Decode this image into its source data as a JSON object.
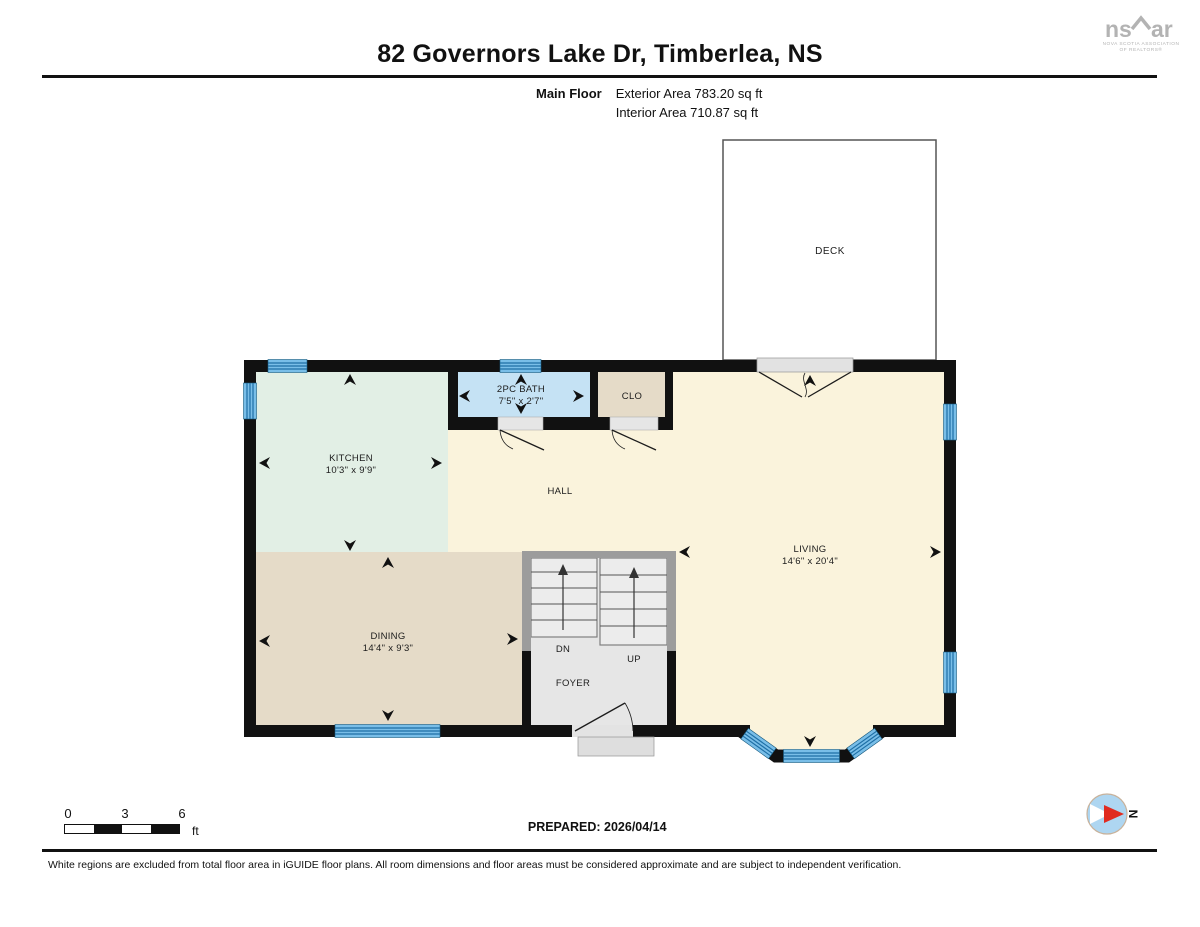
{
  "header": {
    "title": "82 Governors Lake Dr, Timberlea, NS",
    "floor_label": "Main Floor",
    "exterior_area": "Exterior Area 783.20 sq ft",
    "interior_area": "Interior Area 710.87 sq ft"
  },
  "logo": {
    "part1": "ns",
    "part2": "ar",
    "caption_line1": "NOVA SCOTIA ASSOCIATION",
    "caption_line2": "OF REALTORS®"
  },
  "rooms": {
    "deck": {
      "label": "DECK"
    },
    "kitchen": {
      "label": "KITCHEN",
      "dims": "10'3\" x 9'9\""
    },
    "bath": {
      "label": "2PC BATH",
      "dims": "7'5\" x 2'7\""
    },
    "closet": {
      "label": "CLO"
    },
    "hall": {
      "label": "HALL"
    },
    "living": {
      "label": "LIVING",
      "dims": "14'6\" x 20'4\""
    },
    "dining": {
      "label": "DINING",
      "dims": "14'4\" x 9'3\""
    },
    "foyer": {
      "label": "FOYER"
    },
    "stairs": {
      "down": "DN",
      "up": "UP"
    }
  },
  "footer": {
    "scale": {
      "tick0": "0",
      "tick3": "3",
      "tick6": "6",
      "unit": "ft"
    },
    "prepared": "PREPARED: 2026/04/14",
    "compass_north": "N",
    "disclaimer": "White regions are excluded from total floor area in iGUIDE floor plans. All room dimensions and floor areas must be considered approximate and are subject to independent verification."
  },
  "colors": {
    "wall": "#111111",
    "floor_cream": "#FAF3DC",
    "kitchen_mint": "#E2EFE5",
    "dining_tan": "#E5DBC8",
    "bath_blue": "#C5E2F4",
    "window_blue": "#79BEE8",
    "window_stripe": "#1E6FA5",
    "stair_gray": "#ECECEC",
    "compass_red": "#E02B20",
    "logo_gray": "#B3B3B3"
  }
}
